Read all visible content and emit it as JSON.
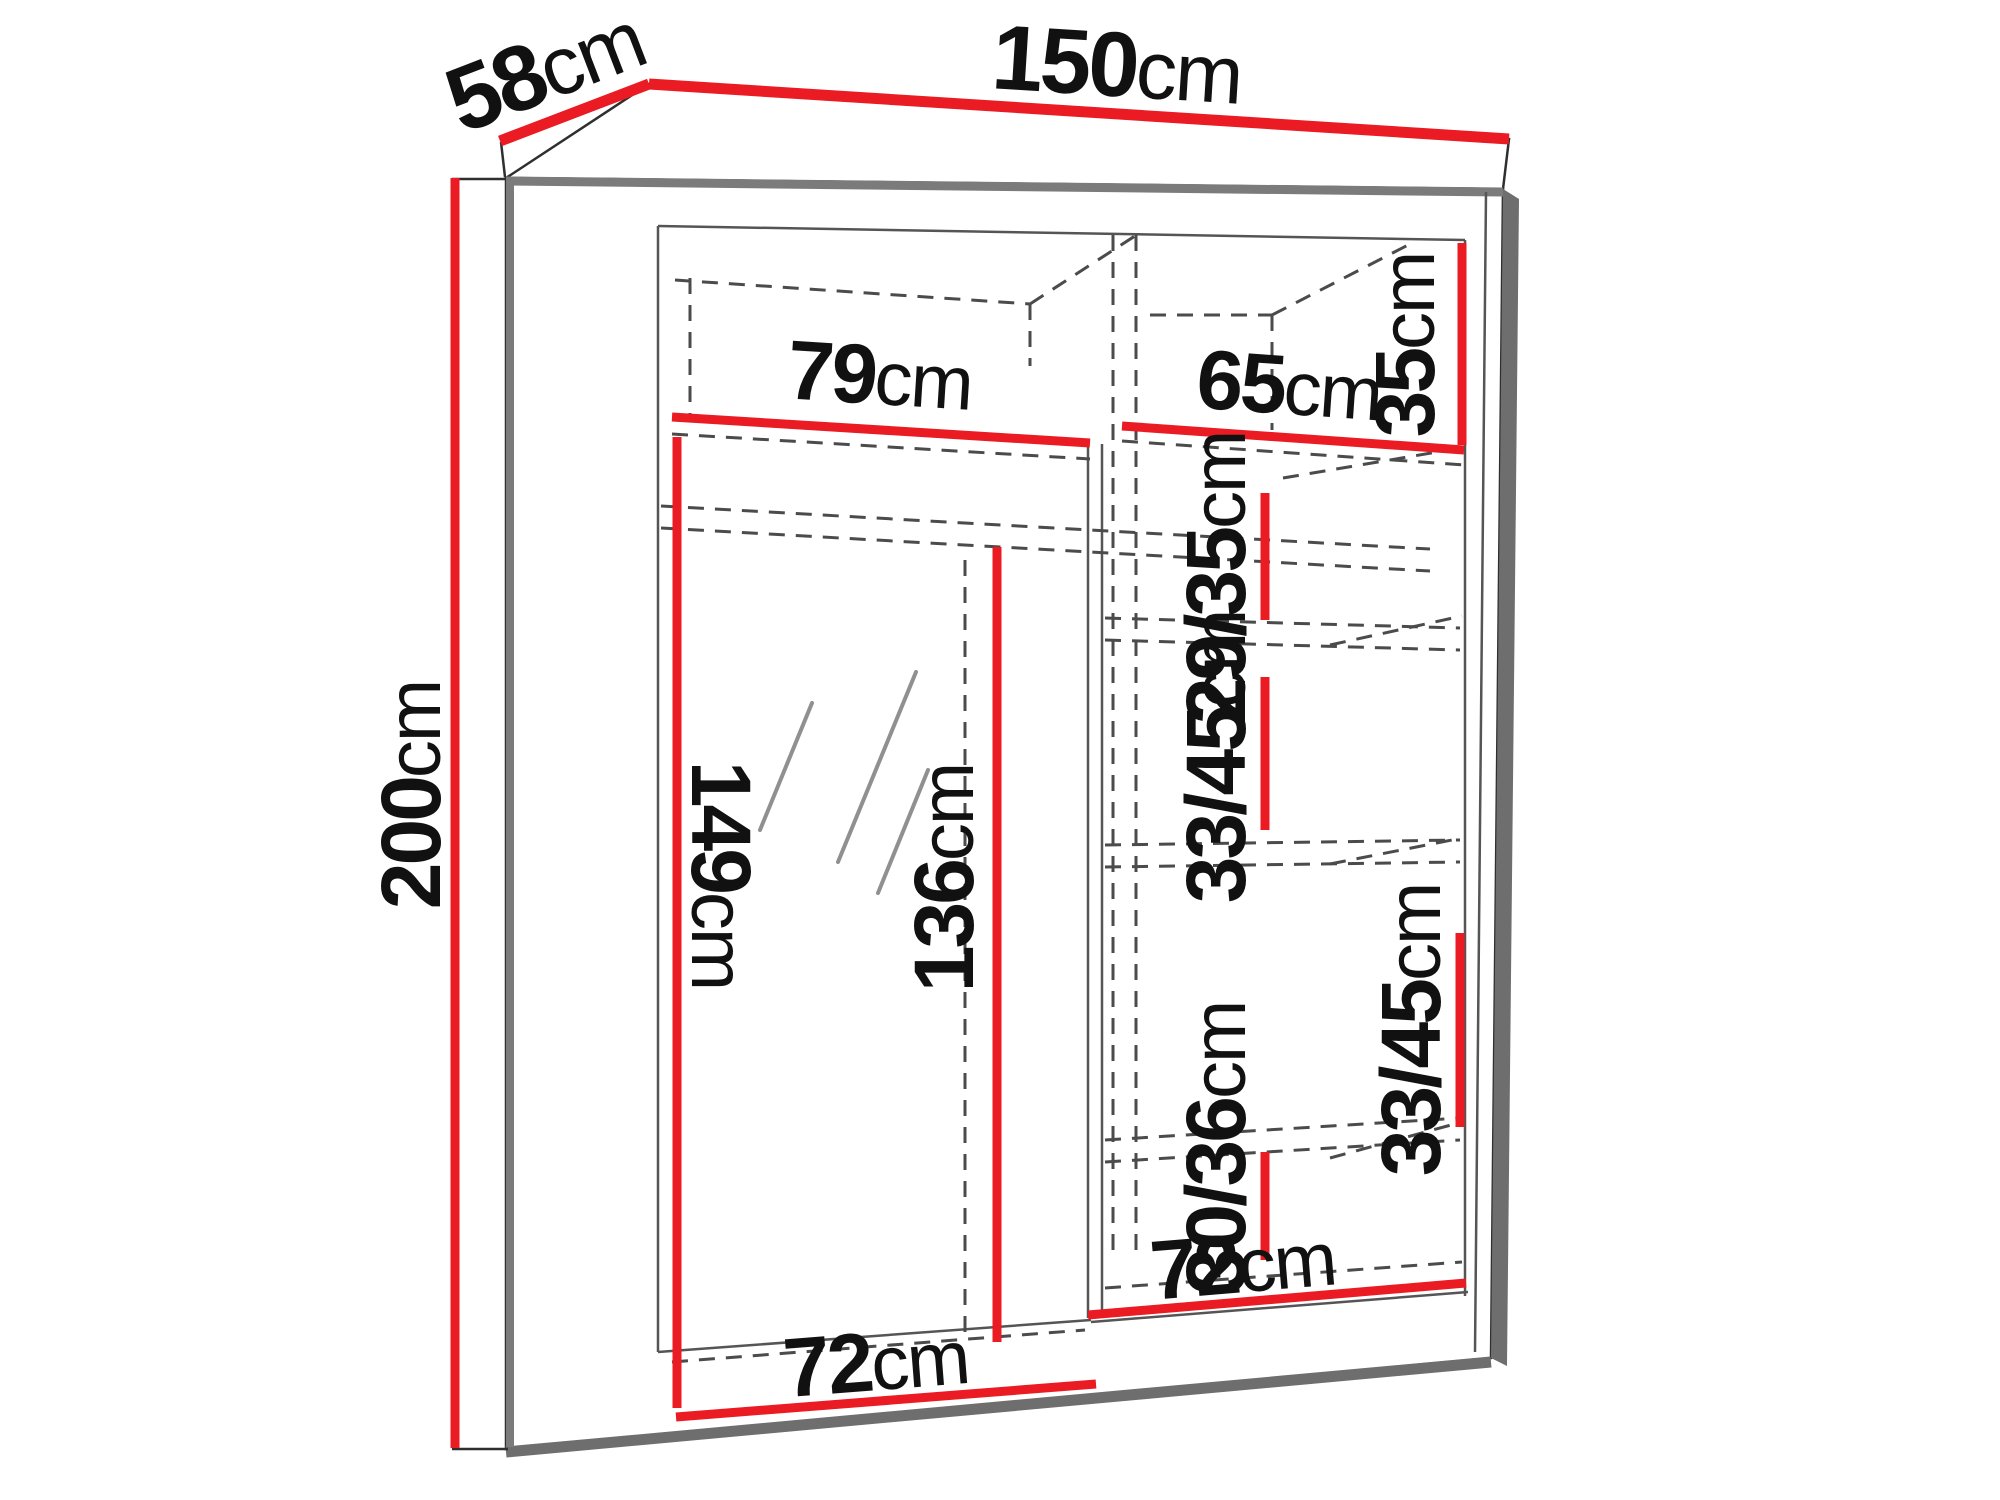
{
  "diagram": {
    "type": "furniture-dimension-diagram",
    "subject": "two-door sliding wardrobe with mirror, interior shelves",
    "unit": "cm",
    "colors": {
      "dimension_line": "#ea1b22",
      "edge_gray": "#7b7b7b",
      "outline": "#2f2f2f",
      "dashed_line": "#4b4b4b",
      "background": "#ffffff",
      "label_text": "#111111"
    },
    "dims": {
      "overall_width": {
        "value": "150",
        "unit": "cm"
      },
      "depth": {
        "value": "58",
        "unit": "cm"
      },
      "overall_height": {
        "value": "200",
        "unit": "cm"
      },
      "left_top_shelf_width": {
        "value": "79",
        "unit": "cm"
      },
      "right_top_shelf_width": {
        "value": "65",
        "unit": "cm"
      },
      "top_compartment_height": {
        "value": "35",
        "unit": "cm"
      },
      "upper_section_height": {
        "value": "29/35",
        "unit": "cm"
      },
      "middle_section_height": {
        "value": "33/45",
        "unit": "cm"
      },
      "lower_section_height": {
        "value": "33/45",
        "unit": "cm"
      },
      "bottom_section_height": {
        "value": "30/36",
        "unit": "cm"
      },
      "mirror_door_height": {
        "value": "149",
        "unit": "cm"
      },
      "inner_door_height": {
        "value": "136",
        "unit": "cm"
      },
      "left_floor_width": {
        "value": "72",
        "unit": "cm"
      },
      "right_floor_width": {
        "value": "72",
        "unit": "cm"
      }
    }
  }
}
